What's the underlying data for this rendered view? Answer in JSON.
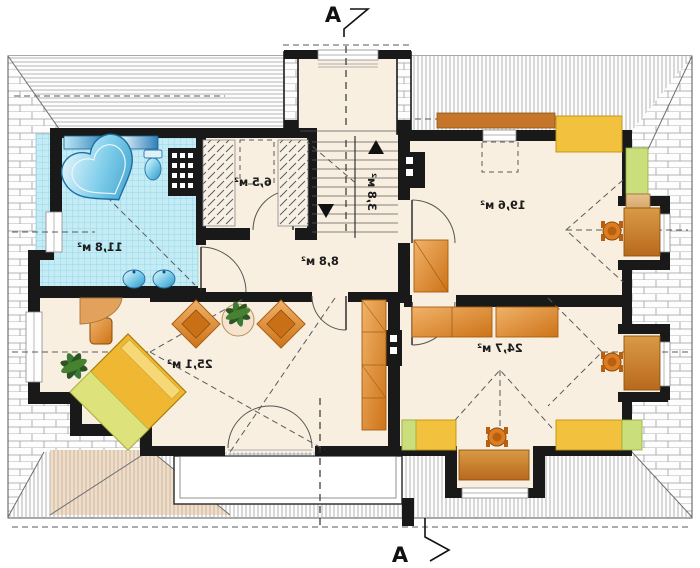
{
  "plan": {
    "type": "attic-floor-plan",
    "note_text_is_mirrored": true,
    "section_markers": {
      "top_label": "A",
      "bottom_label": "A"
    },
    "rooms": {
      "bathroom": {
        "area_label": "11,8 м²"
      },
      "wardrobe": {
        "area_label": "6,5 м²"
      },
      "staircase": {
        "area_label": "3,8 м²"
      },
      "hall": {
        "area_label": "8,8 м²"
      },
      "bedroom_top_right": {
        "area_label": "19,6 м²"
      },
      "living_bottom_left": {
        "area_label": "25,1 м²"
      },
      "bedroom_bottom_right": {
        "area_label": "24,7 м²"
      }
    },
    "colors": {
      "floor": "#f9efe0",
      "wall": "#191919",
      "bath_tile": "#c5ebf5",
      "bath_tile_grid": "#86d3e6",
      "fixture_blue": "#58b9e0",
      "furniture_orange": "#e0862e",
      "furniture_tan": "#d8a76b",
      "furniture_yellow": "#f2c23e",
      "accent_green": "#cadf7c",
      "bay_roof_tan": "#e0b98a",
      "roof_hatch_line": "#969696",
      "dashed_line": "#5a5a5a"
    }
  }
}
